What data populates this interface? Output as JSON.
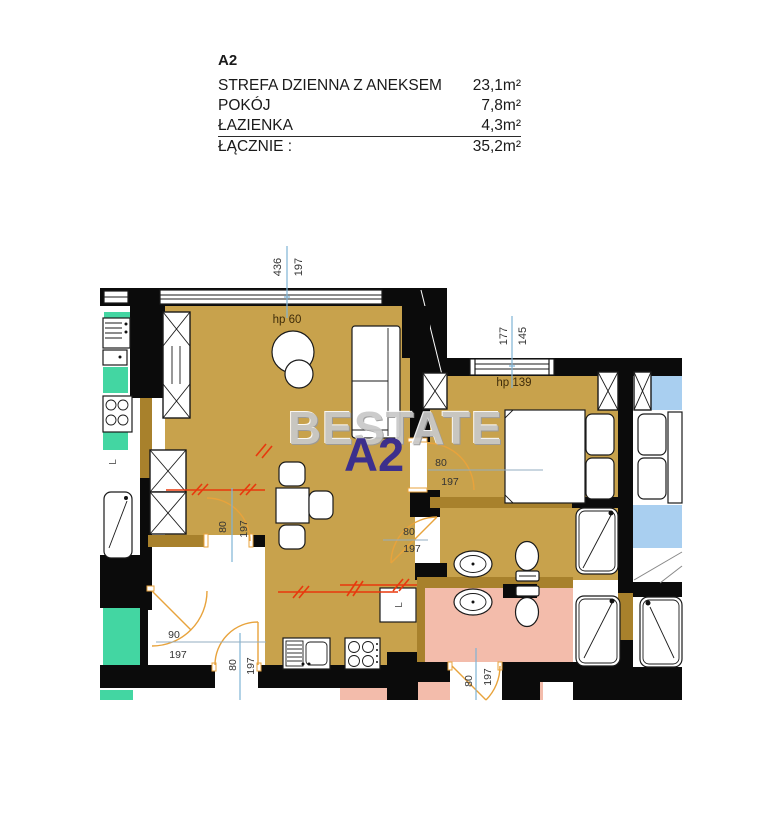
{
  "legend": {
    "unit_id": "A2",
    "rows": [
      {
        "label": "STREFA DZIENNA Z ANEKSEM",
        "area": "23,1m²"
      },
      {
        "label": "POKÓJ",
        "area": "7,8m²"
      },
      {
        "label": "ŁAZIENKA",
        "area": "4,3m²"
      },
      {
        "label": "ŁĄCZNIE :",
        "area": "35,2m²"
      }
    ]
  },
  "watermark": {
    "brand": "BESTATE",
    "unit_label": "A2"
  },
  "annotations": {
    "top_window": {
      "width_cm": "436",
      "height_cm": "197",
      "sill": "hp 60"
    },
    "bedroom_window": {
      "width_cm": "177",
      "height_cm": "145",
      "sill": "hp 139"
    },
    "doors": [
      {
        "location": "living-to-bedroom",
        "width_cm": "80",
        "height_cm": "197"
      },
      {
        "location": "living-to-bathroom",
        "width_cm": "80",
        "height_cm": "197"
      },
      {
        "location": "living-to-hall",
        "width_cm": "80",
        "height_cm": "197"
      },
      {
        "location": "hall-corridor",
        "width_cm": "90",
        "height_cm": "197"
      },
      {
        "location": "entrance",
        "width_cm": "80",
        "height_cm": "197"
      },
      {
        "location": "neighbor-bathroom",
        "width_cm": "80",
        "height_cm": "197"
      }
    ],
    "washer_label": "L"
  },
  "colors": {
    "floor_tan": "#c8a24c",
    "floor_pink": "#f3bcab",
    "floor_blue": "#a9cff0",
    "floor_teal": "#43d6a2",
    "wall_black": "#0b0b0b",
    "wall_brown": "#a8812c",
    "door_arc": "#e8a33c",
    "hatch_red": "#e8380d",
    "dimension_blue": "#7fb3d6",
    "watermark_gray": "#c9c9c9",
    "watermark_purple": "#3c2f8c"
  }
}
